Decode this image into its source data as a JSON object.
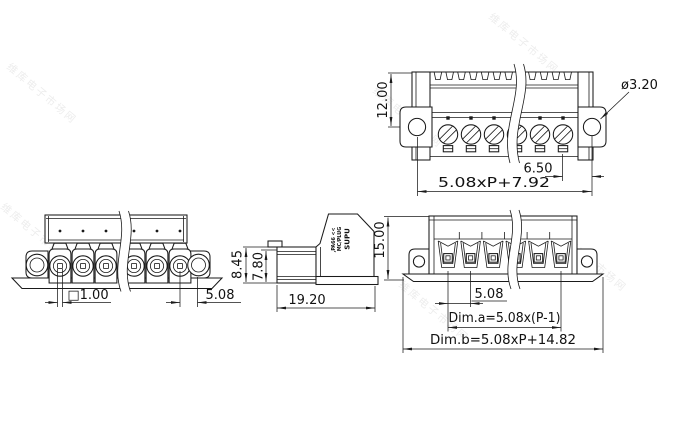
{
  "drawing": {
    "positions_shown": 6,
    "views": {
      "top": {
        "dims": {
          "body_height": "12.00",
          "mount_hole_diameter": "ø3.20",
          "hole_to_pin": "6.50",
          "overall_width": "5.08xP+7.92"
        }
      },
      "front_plug": {
        "dims": {
          "pin_square": "□1.00",
          "pitch": "5.08"
        }
      },
      "side": {
        "dims": {
          "plug_height": "8.45",
          "inner_height": "7.80",
          "depth": "19.20"
        },
        "marking": [
          "SUPU",
          "MC/PLUG",
          ",PA66 <<"
        ]
      },
      "front_header": {
        "dims": {
          "total_height": "15.00",
          "pitch": "5.08",
          "dim_a": "Dim.a=5.08x(P-1)",
          "dim_b": "Dim.b=5.08xP+14.82"
        }
      }
    },
    "watermark": {
      "text": "维库电子市场网"
    },
    "colors": {
      "line": "#1a1a1a",
      "background": "#ffffff",
      "watermark": "#ededed",
      "text": "#111111"
    }
  }
}
